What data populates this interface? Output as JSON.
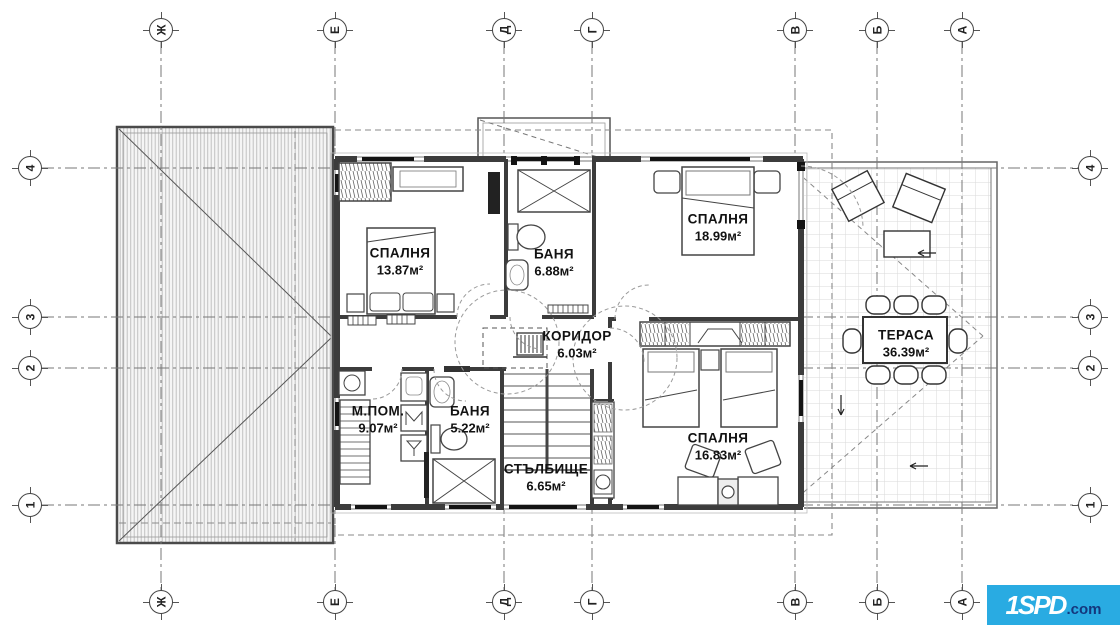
{
  "rooms": [
    {
      "name": "СПАЛНЯ",
      "area": "13.87м²"
    },
    {
      "name": "БАНЯ",
      "area": "6.88м²"
    },
    {
      "name": "СПАЛНЯ",
      "area": "18.99м²"
    },
    {
      "name": "КОРИДОР",
      "area": "6.03м²"
    },
    {
      "name": "М.ПОМ.",
      "area": "9.07м²"
    },
    {
      "name": "БАНЯ",
      "area": "5.22м²"
    },
    {
      "name": "СТЪЛБИЩЕ",
      "area": "6.65м²"
    },
    {
      "name": "СПАЛНЯ",
      "area": "16.83м²"
    },
    {
      "name": "ТЕРАСА",
      "area": "36.39м²"
    }
  ],
  "grid": {
    "columns": [
      "Ж",
      "Е",
      "Д",
      "Г",
      "В",
      "Б",
      "А"
    ],
    "rows": [
      "4",
      "3",
      "2",
      "1"
    ]
  },
  "logo": {
    "main": "1SPD",
    "suffix": ".com",
    "background": "#29abe2"
  },
  "colors": {
    "wall": "#3c3c3c",
    "accent": "#29abe2",
    "gridline": "#777777"
  }
}
